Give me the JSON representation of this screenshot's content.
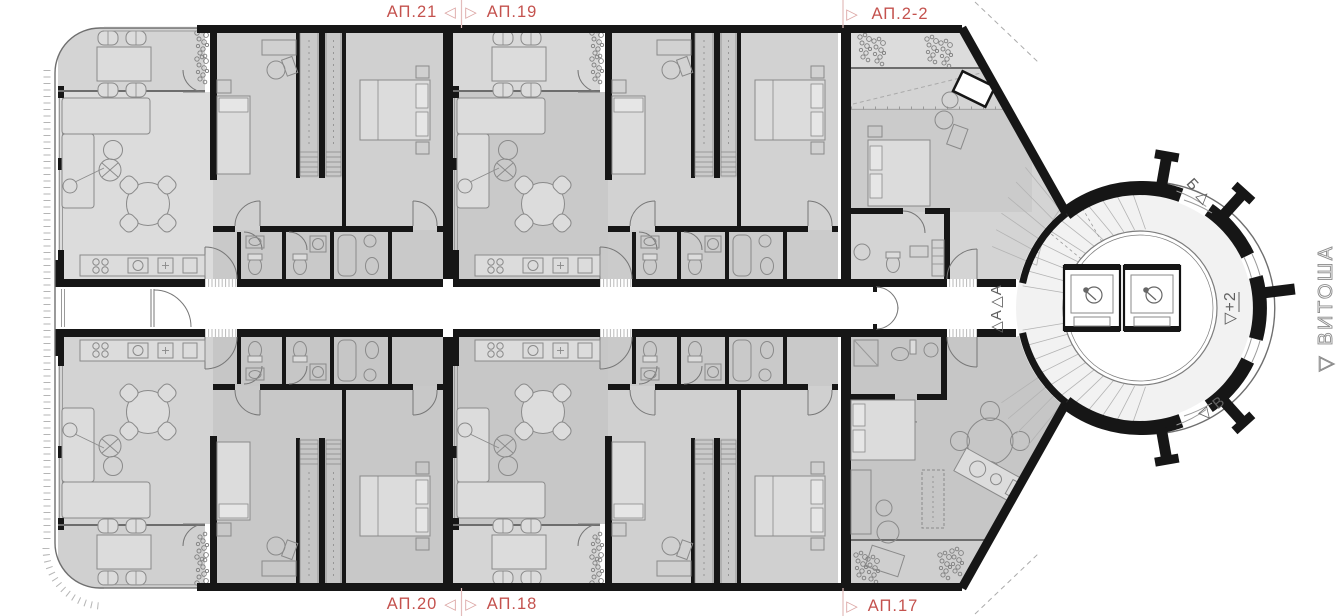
{
  "plan": {
    "type": "architectural-floor-plan",
    "labels": {
      "ap21": "АП.21",
      "ap19": "АП.19",
      "ap22": "АП.2-2",
      "ap20": "АП.20",
      "ap18": "АП.18",
      "ap17": "АП.17"
    },
    "markers": {
      "pair_left": "◁",
      "pair_right": "▷",
      "section_a_top": "△А",
      "section_a_bottom": "△А",
      "entrance_b": "Б △",
      "entrance_v": "▽ В",
      "level_note": "▽+2",
      "direction_label": "▽ ВИТОША"
    },
    "colors": {
      "label_red": "#c4524e",
      "marker_red_light": "#dba3a1",
      "divider_red_line": "#e3bcbb",
      "wall_black": "#161616",
      "room_gray_light": "#dcdcdc",
      "room_gray_mid": "#cdcdcd",
      "room_gray_dark": "#c3c3c3",
      "line_gray": "#9a9a9a"
    }
  }
}
